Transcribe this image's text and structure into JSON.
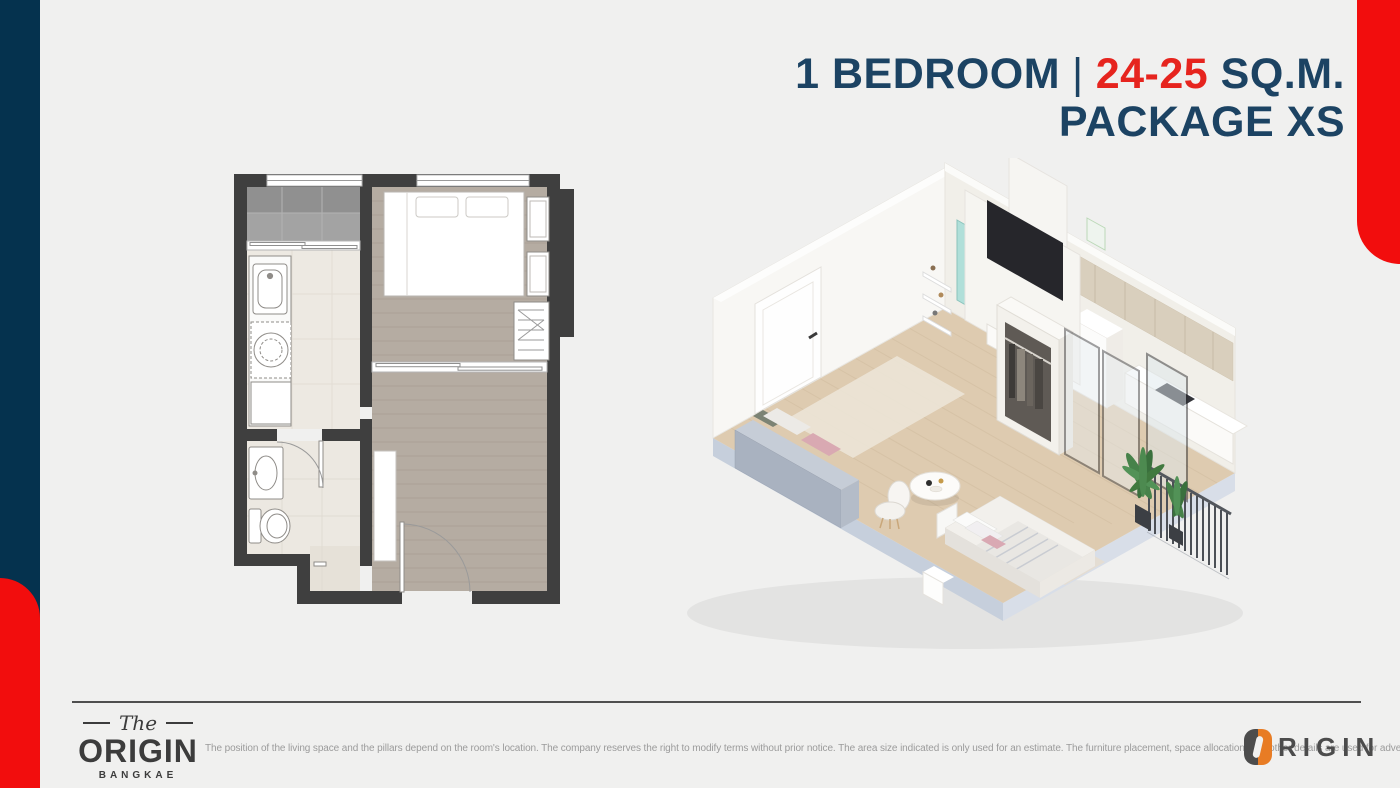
{
  "colors": {
    "background": "#f0f0ef",
    "navy": "#05324e",
    "red": "#f20d0d",
    "title_navy": "#1c4363",
    "title_red": "#e6241e",
    "divider": "#4f4f4f",
    "logo_dark": "#3c3c3c",
    "origin_logo_gray": "#4c4c4c",
    "origin_logo_orange": "#e87c24",
    "disclaimer_gray": "#9b9b9b"
  },
  "title": {
    "bedrooms": "1 BEDROOM",
    "sep": "|",
    "area": "24-25",
    "unit": "SQ.M.",
    "line2": "PACKAGE XS"
  },
  "footer": {
    "the": "The",
    "origin": "ORIGIN",
    "location": "BANGKAE",
    "disclaimer": "The position of the living space and the pillars depend on the room's location. The company reserves the right to modify terms without prior notice. The area size indicated is only used for an estimate. The furniture placement, space allocation, and other details are used for advertising purposes only.",
    "origin_right": "RIGIN"
  }
}
